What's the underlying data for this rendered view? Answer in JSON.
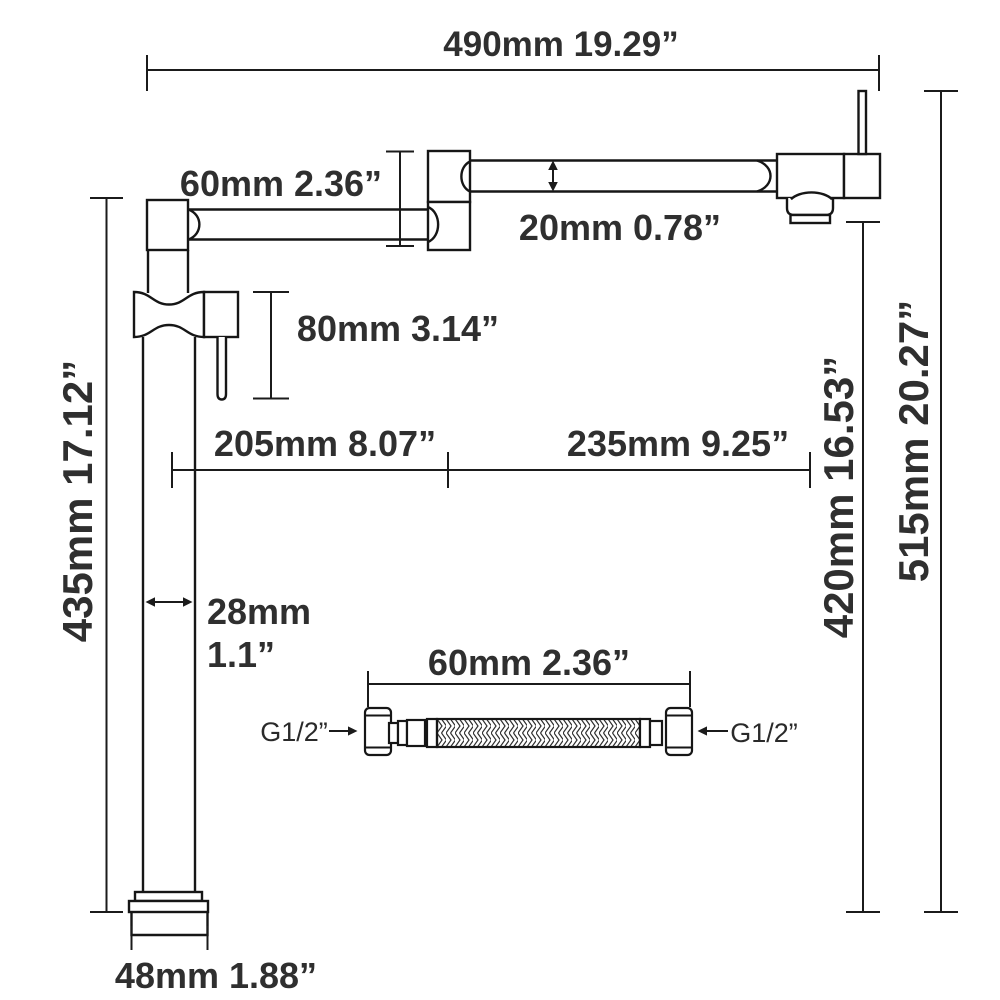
{
  "diagram": {
    "title": "Pot filler faucet dimension diagram",
    "labels": {
      "overall_width": "490mm 19.29”",
      "joint_height": "60mm 2.36”",
      "arm_thickness": "20mm 0.78”",
      "handle_drop": "80mm 3.14”",
      "column_height": "435mm 17.12”",
      "inner_reach": "205mm 8.07”",
      "outer_reach": "235mm 9.25”",
      "spout_clearance": "420mm 16.53”",
      "total_height": "515mm 20.27”",
      "pipe_diameter_mm": "28mm",
      "pipe_diameter_in": "1.1”",
      "base_width": "48mm 1.88”",
      "hose_length": "60mm 2.36”",
      "thread_left": "G1/2”",
      "thread_right": "G1/2”"
    },
    "colors": {
      "line": "#161616",
      "dimension_line": "#1b1b1b",
      "text": "#2f2f2f",
      "background": "#ffffff"
    }
  }
}
